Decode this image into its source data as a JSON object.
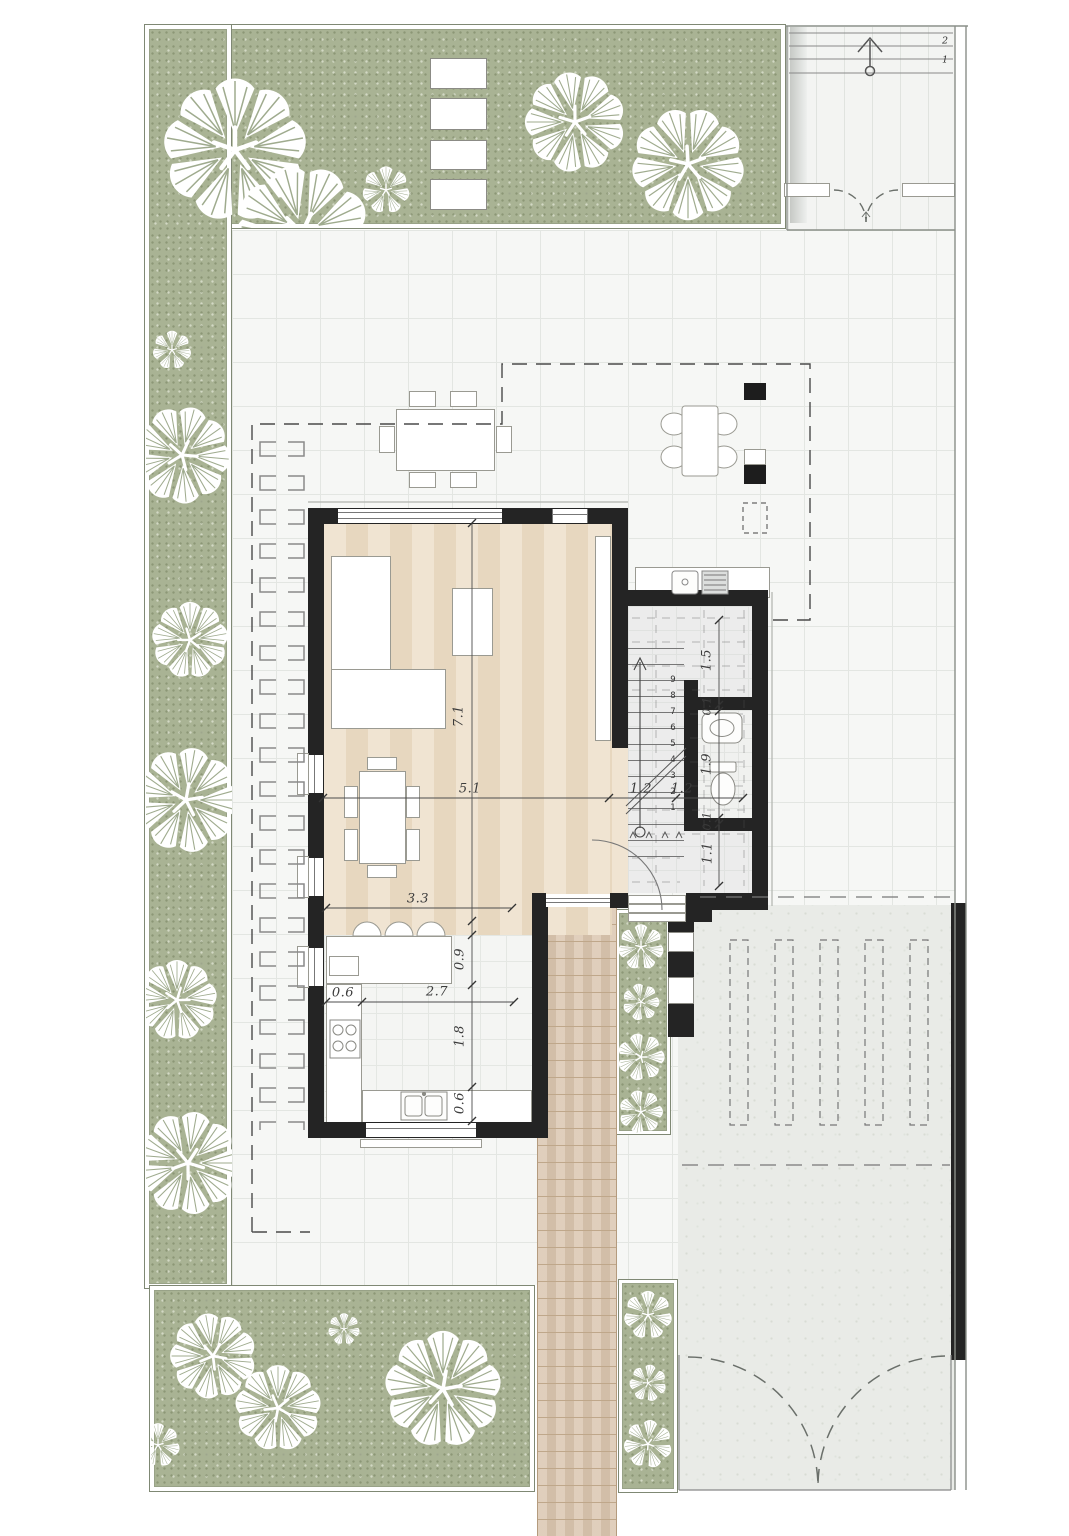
{
  "plan": {
    "kind": "residential ground-floor architectural plan",
    "colors": {
      "garden_green": "#a9b394",
      "wall_black": "#242424",
      "wood_floor": "#eee0cb",
      "deck_wood": "#d9c4ad",
      "terrace_tile": "#f6f7f5",
      "driveway_concrete": "#e9ebe7",
      "dimension_text": "#3c3c3c",
      "tree_white": "#ffffff"
    }
  },
  "dimensions": {
    "living_depth": "7.1",
    "living_width": "5.1",
    "kitchen_width": "3.3",
    "kitchen_counter": "0.6",
    "kitchen_inner": "2.7",
    "kitchen_d1": "0.9",
    "kitchen_d2": "1.8",
    "kitchen_d3": "0.6",
    "hall_seg1": "1.2",
    "hall_seg2": "1.2",
    "stair_width": "1.5",
    "wc_wall_top": "0.1",
    "wc_length": "1.9",
    "wc_wall_bottom": "0.1",
    "hall_depth": "1.1"
  },
  "stairs": {
    "numbers": [
      "1",
      "2",
      "3",
      "4",
      "5",
      "6",
      "7",
      "8",
      "9"
    ]
  },
  "entry_steps": {
    "labels": [
      "2",
      "1"
    ]
  }
}
